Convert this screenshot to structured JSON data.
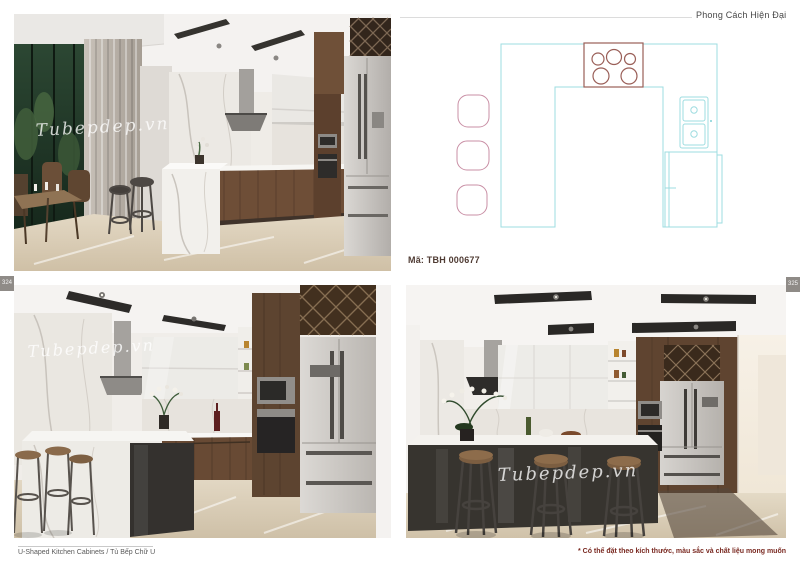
{
  "header": {
    "style_label": "Phong Cách Hiện Đại"
  },
  "plan": {
    "code": "Mã: TBH 000677",
    "type": "floor-plan-top-view",
    "elements": [
      "u-shaped-counter",
      "cooktop-5-burners",
      "double-sink",
      "refrigerator",
      "three-bar-chairs"
    ]
  },
  "page_numbers": {
    "left": "324",
    "right": "325"
  },
  "footer": {
    "caption": "U-Shaped Kitchen Cabinets / Tủ Bếp Chữ U",
    "note": "* Có thể đặt theo kích thước, màu sắc và chất liệu mong muốn"
  },
  "watermark": "Tubepdep.vn",
  "colors": {
    "plan_counter_line": "#9edce0",
    "plan_chair_line": "#c98fa5",
    "plan_cooktop_line": "#9a5f58",
    "code_text": "#4f3b33",
    "note_text": "#7a2a22",
    "tab_bg": "#8f8b87"
  }
}
